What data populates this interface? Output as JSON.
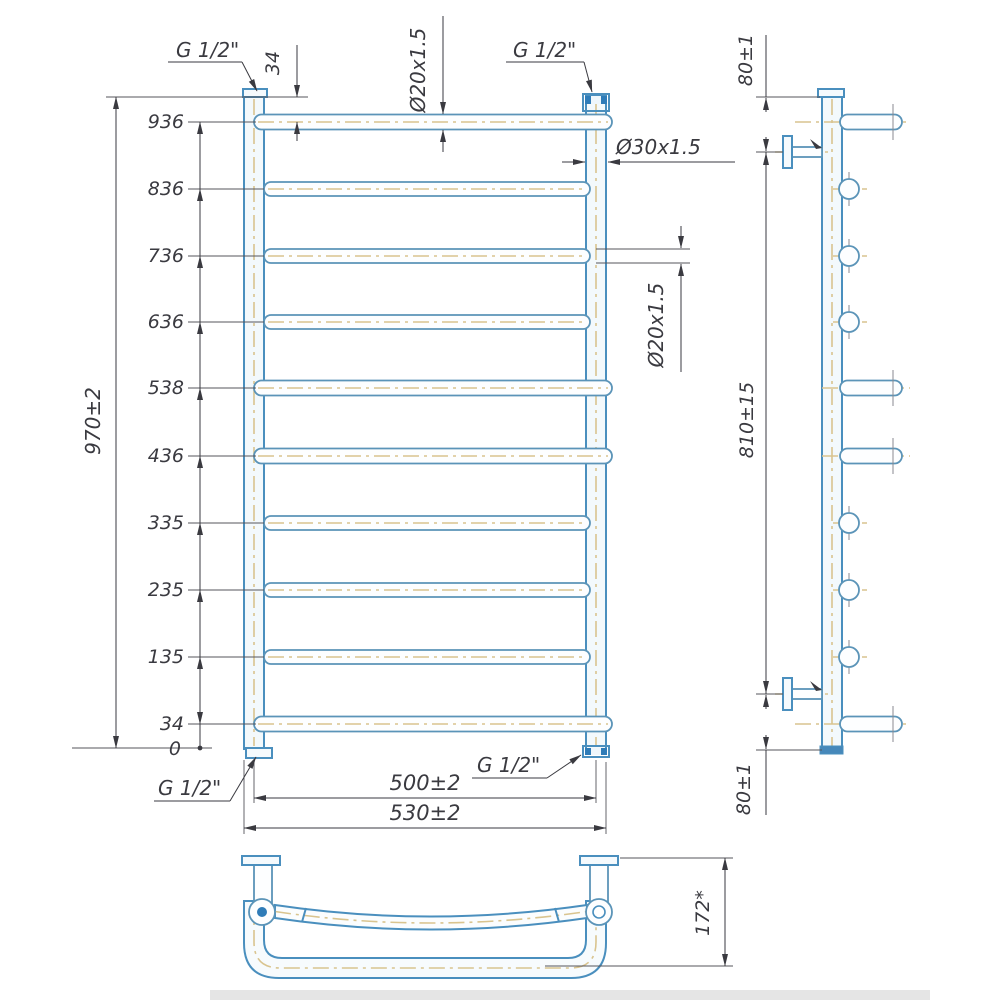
{
  "drawing_type": "towel-rail-technical-drawing",
  "colors": {
    "outline_blue": "#4a8fbe",
    "centerline_tan": "#d9c48f",
    "dimension_gray": "#3a3a40",
    "fitting_blue": "#2f7cb8"
  },
  "front": {
    "heights": [
      "936",
      "836",
      "736",
      "636",
      "538",
      "436",
      "335",
      "235",
      "135",
      "34",
      "0"
    ],
    "overall_height": "970±2",
    "top_rung_offset": "34",
    "rung_dia_top": "Ø20x1.5",
    "rung_dia_right": "Ø20x1.5",
    "tube_dia": "Ø30x1.5",
    "width_centers": "500±2",
    "width_overall": "530±2",
    "fittings": {
      "top_left": "G 1/2\"",
      "top_right": "G 1/2\"",
      "bottom_left": "G 1/2\"",
      "bottom_right": "G 1/2\""
    }
  },
  "side": {
    "top_offset": "80±1",
    "mount_span": "810±15",
    "bottom_offset": "80±1"
  },
  "top_view": {
    "depth": "172*"
  }
}
